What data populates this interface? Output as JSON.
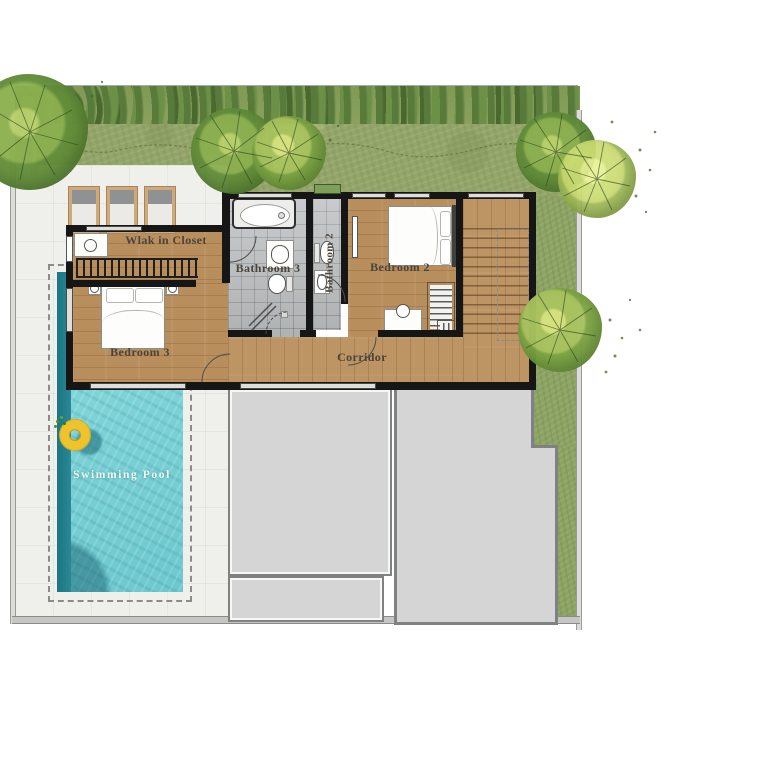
{
  "labels": {
    "walk_in_closet": "Wlak in Closet",
    "bathroom_3": "Bathroom 3",
    "bathroom_2": "Bathroom 2",
    "bedroom_2": "Bedroom 2",
    "bedroom_3": "Bedroom 3",
    "corridor": "Corridor",
    "swimming_pool": "Swimming Pool"
  },
  "colors": {
    "grass": "#93a569",
    "hedge_dark": "#4f7036",
    "wood_floor": "#b98e5d",
    "bath_tile": "#b9bcbd",
    "terrace_tile": "#efefeb",
    "roof": "#d4d5d4",
    "pool_water": "#7cd2d6",
    "pool_edge": "#1f7e8d",
    "wall": "#161616",
    "swim_ring": "#eec32b",
    "label_text": "#4a443a",
    "pool_label_text": "#f8fcfa"
  },
  "icons": {
    "tree": "round watercolor canopy with radial branches",
    "sun_lounger": "cushioned lounger",
    "double_bed": "bed with two pillows",
    "bathtub": "oval bathtub",
    "toilet": "toilet bowl with tank",
    "sink": "vanity with oval basin",
    "shower": "shower corner with drain",
    "swim_ring": "yellow pool float",
    "staircase": "treads with dashed handrail",
    "wardrobe": "hanger rail",
    "desk_chair": "desk with round stool"
  }
}
